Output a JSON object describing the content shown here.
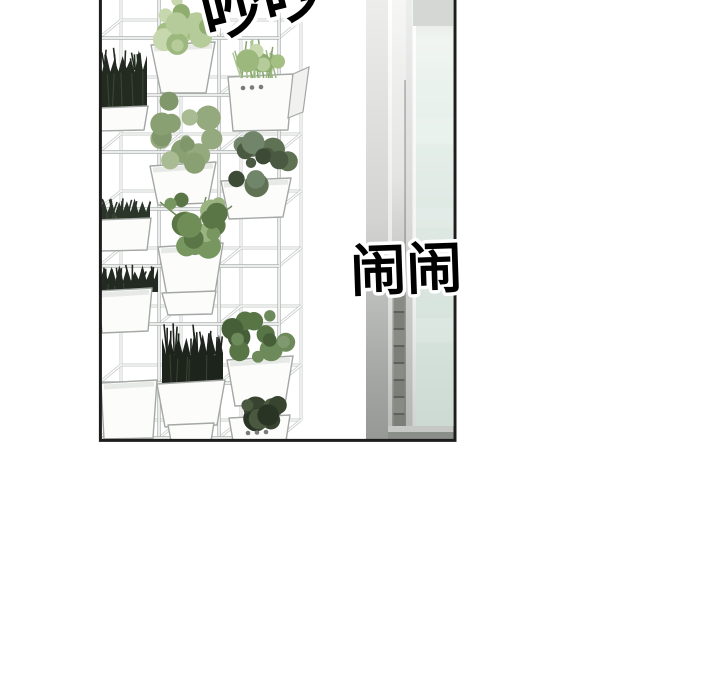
{
  "scene": {
    "type": "webtoon-panel",
    "description": "Comic panel: a tall vertical-garden shelf of white cube planters with assorted green plants stands beside a glass door; noisy chatter sound-effect lettering overlays the panel.",
    "sfx": {
      "top": "吵吵",
      "middle": "闹闹"
    },
    "colors": {
      "background": "#ffffff",
      "panel_border": "#1d1d1d",
      "frame_front": "#aeb3b0",
      "frame_back": "#c9cdca",
      "pot_white": "#fcfcfb",
      "pot_outline": "#a4a8a5",
      "pot_shade": "#e7e9e6",
      "pot_side": "#f1f2f0",
      "pot_dot": "#797c79",
      "glass_green": "#dce8e2",
      "door_gray": "#9b9c9b",
      "plant_light": "#aec68f",
      "plant_mid": "#7e9a68",
      "plant_dark": "#232b21",
      "sfx_fill": "#000000",
      "sfx_outline": "#ffffff"
    }
  }
}
